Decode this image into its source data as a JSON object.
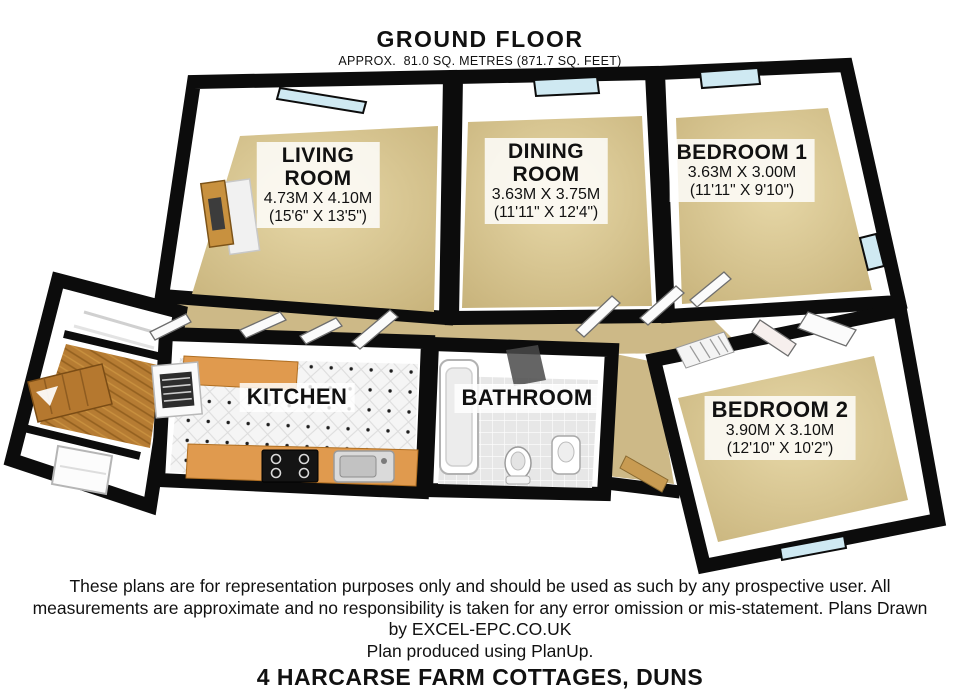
{
  "header": {
    "title": "GROUND FLOOR",
    "subtitle": "APPROX.  81.0 SQ. METRES (871.7 SQ. FEET)"
  },
  "rooms": {
    "living": {
      "name_line1": "LIVING",
      "name_line2": "ROOM",
      "dims_metric": "4.73M X 4.10M",
      "dims_imperial": "(15'6\" X 13'5\")"
    },
    "dining": {
      "name_line1": "DINING",
      "name_line2": "ROOM",
      "dims_metric": "3.63M X 3.75M",
      "dims_imperial": "(11'11\" X 12'4\")"
    },
    "bedroom1": {
      "name": "BEDROOM 1",
      "dims_metric": "3.63M X 3.00M",
      "dims_imperial": "(11'11\" X 9'10\")"
    },
    "kitchen": {
      "name": "KITCHEN"
    },
    "bathroom": {
      "name": "BATHROOM"
    },
    "bedroom2": {
      "name": "BEDROOM 2",
      "dims_metric": "3.90M X 3.10M",
      "dims_imperial": "(12'10\" X 10'2\")"
    }
  },
  "footer": {
    "disclaimer_lines": [
      "These plans are for representation purposes only and should be used as such by any prospective user. All",
      "measurements are approximate and no responsibility is taken for any error omission or mis-statement. Plans Drawn",
      "by EXCEL-EPC.CO.UK",
      "Plan produced using PlanUp."
    ],
    "address": "4 HARCARSE FARM COTTAGES, DUNS"
  },
  "colors": {
    "wall": "#0c0c0c",
    "carpet_light": "#e7d8a8",
    "carpet_edge": "#c7b27a",
    "hall_carpet": "#cdb987",
    "counter": "#e09a4e",
    "wood": "#b5782f",
    "glass": "#cfe9f2"
  }
}
